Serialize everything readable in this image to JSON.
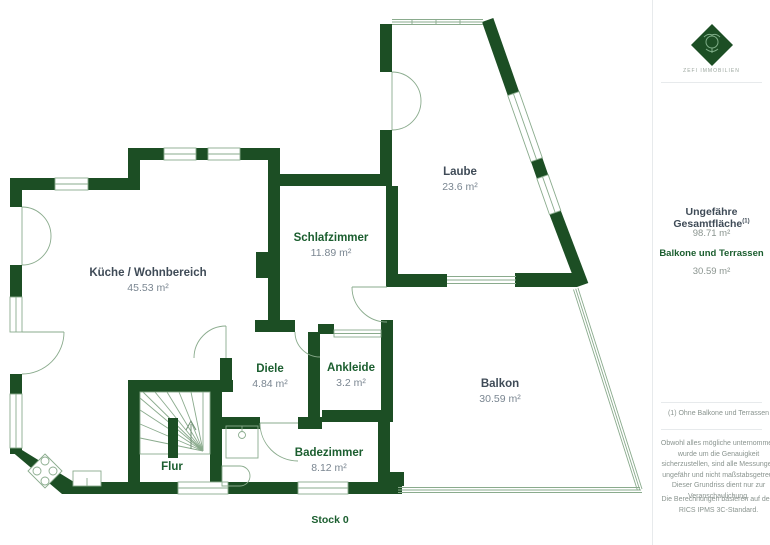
{
  "floorplan": {
    "floor_label": "Stock 0",
    "rooms": [
      {
        "name": "Küche / Wohnbereich",
        "area": "45.53 m²",
        "name_color": "#3f4b57"
      },
      {
        "name": "Schlafzimmer",
        "area": "11.89 m²",
        "name_color": "#1b5e2f"
      },
      {
        "name": "Laube",
        "area": "23.6 m²",
        "name_color": "#3f4b57"
      },
      {
        "name": "Diele",
        "area": "4.84 m²",
        "name_color": "#1b5e2f"
      },
      {
        "name": "Ankleide",
        "area": "3.2 m²",
        "name_color": "#1b5e2f"
      },
      {
        "name": "Balkon",
        "area": "30.59 m²",
        "name_color": "#3f4b57"
      },
      {
        "name": "Badezimmer",
        "area": "8.12 m²",
        "name_color": "#1b5e2f"
      },
      {
        "name": "Flur",
        "area": "",
        "name_color": "#1b5e2f"
      }
    ]
  },
  "sidebar": {
    "brand": {
      "logo_icon": "lion-crest-diamond",
      "name": "ZEFI IMMOBILIEN"
    },
    "summary": {
      "total_label": "Ungefähre Gesamtfläche",
      "total_superscript": "(1)",
      "total_value": "98.71 m²",
      "balcony_label": "Balkone und Terrassen",
      "balcony_value": "30.59 m²"
    },
    "footnote": "(1) Ohne Balkone und Terrassen",
    "disclaimer": "Obwohl alles mögliche unternommen wurde um die Genauigkeit sicherzustellen, sind alle Messungen ungefähr und nicht maßstabsgetreu. Dieser Grundriss dient nur zur Veranschaulichung.",
    "standard_note": "Die Berechnungen basieren auf dem RICS IPMS 3C-Standard."
  },
  "colors": {
    "wall_green": "#1c4e24",
    "thin_line_green": "#8aab8d",
    "room_green": "#1b5e2f",
    "room_slate": "#3f4b57",
    "area_gray": "#7a8691",
    "divider_gray": "#e7eaec"
  }
}
